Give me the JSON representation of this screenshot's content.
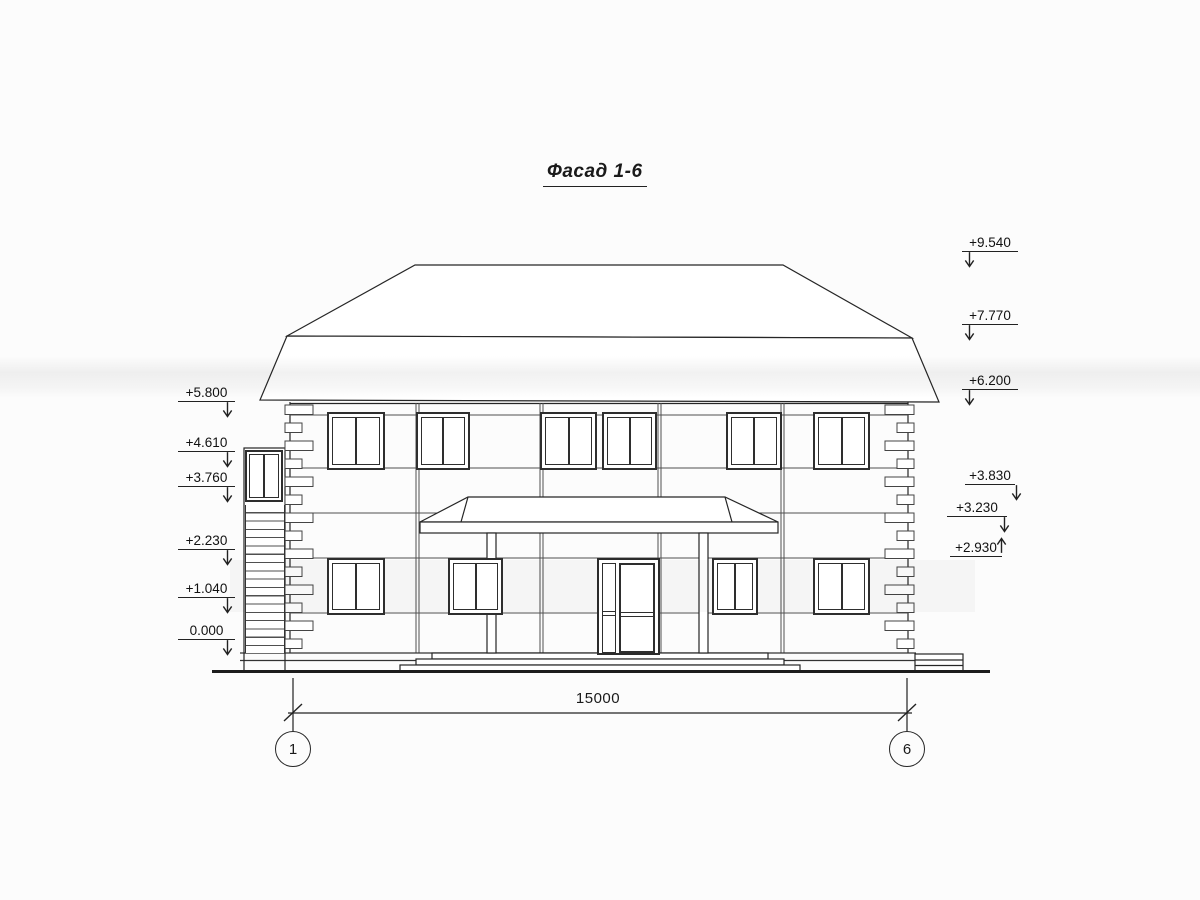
{
  "title": "Фасад 1-6",
  "elevations": {
    "left": [
      {
        "label": "+5.800"
      },
      {
        "label": "+4.610"
      },
      {
        "label": "+3.760"
      },
      {
        "label": "+2.230"
      },
      {
        "label": "+1.040"
      },
      {
        "label": "0.000"
      }
    ],
    "right": [
      {
        "label": "+9.540"
      },
      {
        "label": "+7.770"
      },
      {
        "label": "+6.200"
      },
      {
        "label": "+3.830"
      },
      {
        "label": "+3.230"
      },
      {
        "label": "+2.930"
      }
    ]
  },
  "dimension": {
    "length_label": "15000"
  },
  "axis_markers": [
    {
      "label": "1"
    },
    {
      "label": "6"
    }
  ],
  "colors": {
    "line": "#262626",
    "paper": "#fcfcfc"
  }
}
